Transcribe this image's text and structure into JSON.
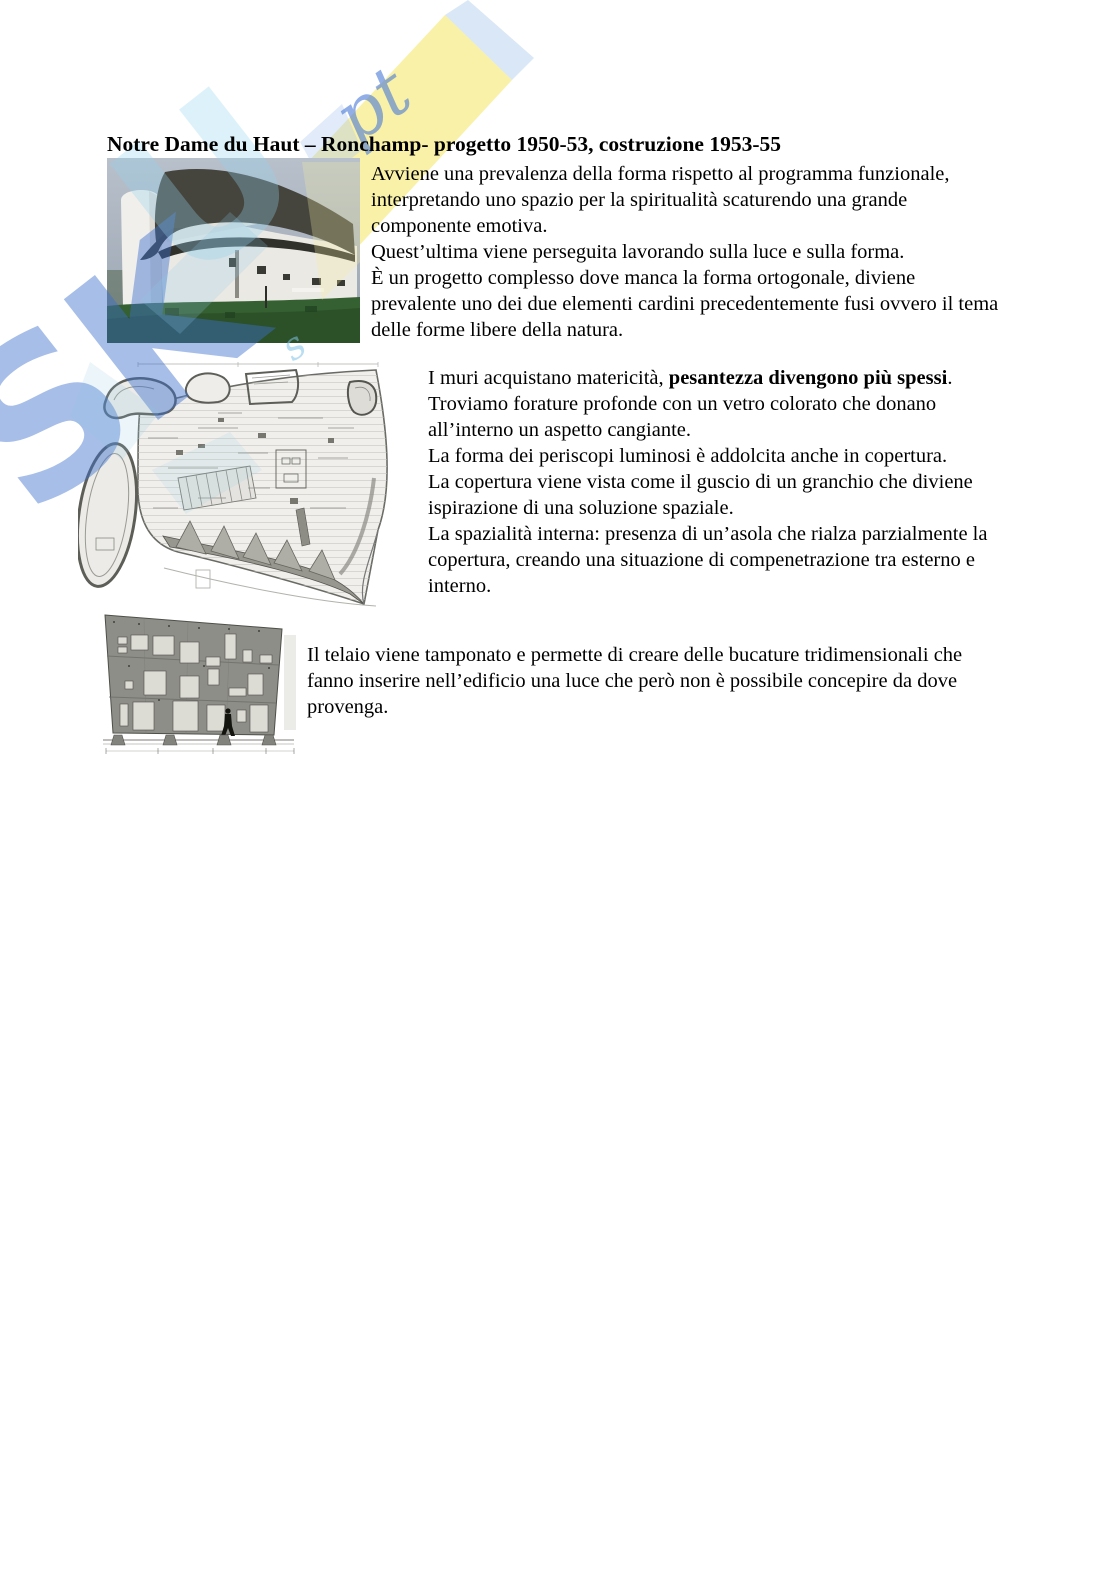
{
  "title": "Notre Dame du Haut – Ronchamp- progetto 1950-53, costruzione 1953-55",
  "watermark": {
    "brand_letters": "SK",
    "overlay_letter": "U",
    "script_glyph": "pt",
    "script_small": "s",
    "yellow": "#f8f0a2",
    "blue": "#3c6cce",
    "cyan": "#9ed2ec"
  },
  "colors": {
    "text": "#000000",
    "page_background": "#ffffff"
  },
  "paragraph_photo": {
    "lines": [
      "Avviene una prevalenza della forma rispetto al programma funzionale,",
      "interpretando uno spazio per la spiritualità scaturendo una grande",
      "componente emotiva.",
      "Quest’ultima viene perseguita lavorando sulla luce e sulla forma.",
      "È un progetto complesso dove manca la forma ortogonale, diviene",
      "prevalente uno dei due elementi cardini precedentemente fusi ovvero il tema",
      "delle forme libere della natura."
    ]
  },
  "paragraph_plan": {
    "line1_pre": "I muri acquistano matericità, ",
    "line1_bold": "pesantezza divengono più spessi",
    "line1_end": ".",
    "lines": [
      "Troviamo forature profonde con un vetro colorato che donano",
      "all’interno un aspetto cangiante.",
      "La forma dei periscopi luminosi è addolcita anche in copertura.",
      "La copertura viene vista come il guscio di un granchio che diviene",
      "ispirazione di una soluzione spaziale.",
      "La spazialità interna: presenza di un’asola che rialza parzialmente la",
      "copertura, creando una situazione di compenetrazione tra esterno e",
      "interno."
    ]
  },
  "paragraph_section": {
    "lines": [
      "Il telaio viene tamponato e permette di creare delle bucature tridimensionali che",
      "fanno inserire nell’edificio una luce che però non è possibile concepire da dove",
      "provenga."
    ]
  }
}
